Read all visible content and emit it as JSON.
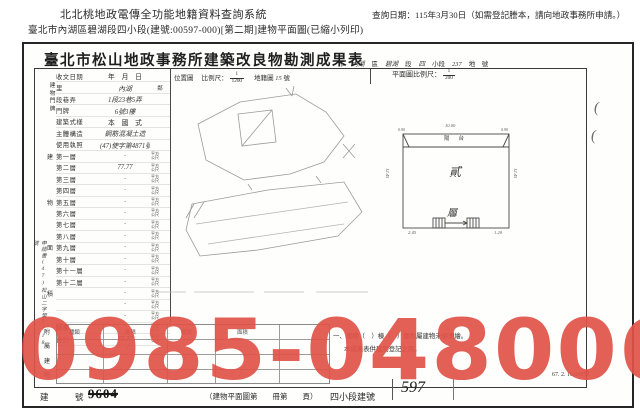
{
  "page_header": {
    "system_title": "北北桃地政電傳全功能地籍資料查詢系統",
    "query_date": "查詢日期：115年3月30日（如需登記謄本，請向地政事務所申請。）",
    "document_path": "臺北市內湖區碧湖段四小段(建號:00597-000)[第二期]建物平面圖(已縮小列印)"
  },
  "form": {
    "title": "臺北市松山地政事務所建築改良物勘測成果表",
    "title_annotation": [
      {
        "t": "市",
        "h": false
      },
      {
        "t": "內湖",
        "h": true
      },
      {
        "t": "區",
        "h": false
      },
      {
        "t": "碧湖",
        "h": true
      },
      {
        "t": "段",
        "h": false
      },
      {
        "t": "四",
        "h": true
      },
      {
        "t": "小段",
        "h": false
      },
      {
        "t": "237",
        "h": true
      },
      {
        "t": "地　號",
        "h": false
      }
    ],
    "location_map": {
      "label": "位置圖",
      "scale_label": "比例尺：",
      "scale_num": "1",
      "scale_den": "1200",
      "sheet_label": "地籍圖",
      "sheet_no": "15",
      "sheet_unit": "號"
    },
    "floor_plan": {
      "scale_label": "平面圖比例尺：",
      "scale_num": "1",
      "scale_den": "200",
      "balcony_label": "陽台",
      "floor_char_top": "貳",
      "floor_char_bottom": "層",
      "dims": {
        "top": "10.00",
        "balcony_left": "0.90",
        "balcony_right": "0.90",
        "left": "12.45",
        "right": "12.45",
        "stair": "4.20",
        "bottom_left": "2.45",
        "bottom_right": "1.20"
      }
    },
    "table": {
      "group_label_address": "建物門牌",
      "group_label_area": "建物面積",
      "group_label_annex": "附屬建物",
      "rows": [
        {
          "label": "收文日期",
          "value": "年　月　日",
          "unit": "",
          "hand": false
        },
        {
          "label": "里",
          "value": "內湖",
          "unit": "鄰",
          "hand": true
        },
        {
          "label": "段巷弄",
          "value": "1段23巷5弄",
          "unit": "",
          "hand": true
        },
        {
          "label": "門牌",
          "value": "6號3樓",
          "unit": "",
          "hand": true
        },
        {
          "label": "建築式樣",
          "value": "本　國　式",
          "unit": "",
          "hand": false
        },
        {
          "label": "主體構造",
          "value": "鋼筋混凝土造",
          "unit": "",
          "hand": true
        },
        {
          "label": "使用執照",
          "value": "(47)使字第4871號",
          "unit": "",
          "hand": true
        },
        {
          "label": "第一層",
          "value": "·",
          "unit": "平方公尺",
          "hand": true
        },
        {
          "label": "第二層",
          "value": "77.77",
          "unit": "平方公尺",
          "hand": true
        },
        {
          "label": "第三層",
          "value": "·",
          "unit": "平方公尺",
          "hand": true
        },
        {
          "label": "第四層",
          "value": "·",
          "unit": "平方公尺",
          "hand": true
        },
        {
          "label": "第五層",
          "value": "·",
          "unit": "平方公尺",
          "hand": true
        },
        {
          "label": "第六層",
          "value": "·",
          "unit": "平方公尺",
          "hand": true
        },
        {
          "label": "第七層",
          "value": "·",
          "unit": "平方公尺",
          "hand": true
        },
        {
          "label": "第八層",
          "value": "·",
          "unit": "平方公尺",
          "hand": true
        },
        {
          "label": "第九層",
          "value": "·",
          "unit": "平方公尺",
          "hand": true
        },
        {
          "label": "第十層",
          "value": "·",
          "unit": "平方公尺",
          "hand": true
        },
        {
          "label": "第十一層",
          "value": "·",
          "unit": "平方公尺",
          "hand": true
        },
        {
          "label": "第十二層",
          "value": "·",
          "unit": "平方公尺",
          "hand": true
        },
        {
          "label": "",
          "value": "·",
          "unit": "平方公尺",
          "hand": true
        },
        {
          "label": "",
          "value": "·",
          "unit": "平方公尺",
          "hand": true
        },
        {
          "label": "",
          "value": "·",
          "unit": "平方公尺",
          "hand": true
        },
        {
          "label": "騎樓",
          "value": "·",
          "unit": "平方公尺",
          "hand": true
        },
        {
          "label": "合計",
          "value": "77.77",
          "unit": "平方公尺",
          "hand": true
        }
      ]
    },
    "annex": {
      "headers": [
        "種類",
        "面積",
        "種類",
        "面積"
      ],
      "slashes": [
        "/",
        "/",
        "/"
      ]
    },
    "margin_note": "申請書(47)松山二字第9718號",
    "margin_marks": [
      "(",
      "("
    ],
    "notes": [
      "一、建物（　）棟（　）層附屬建物未併測繪。",
      "本成果表供建物登記之用。"
    ],
    "footer": {
      "label": "建　號",
      "old_no": "9604",
      "plan_ref": "（建物平面圖第　　冊第　　頁）",
      "new_label": "四小段建號",
      "new_no": "597",
      "print_note": "67. 2. 10,000張"
    }
  },
  "watermark": {
    "text": "0985-048006",
    "color": "rgba(224,82,72,0.92)"
  }
}
